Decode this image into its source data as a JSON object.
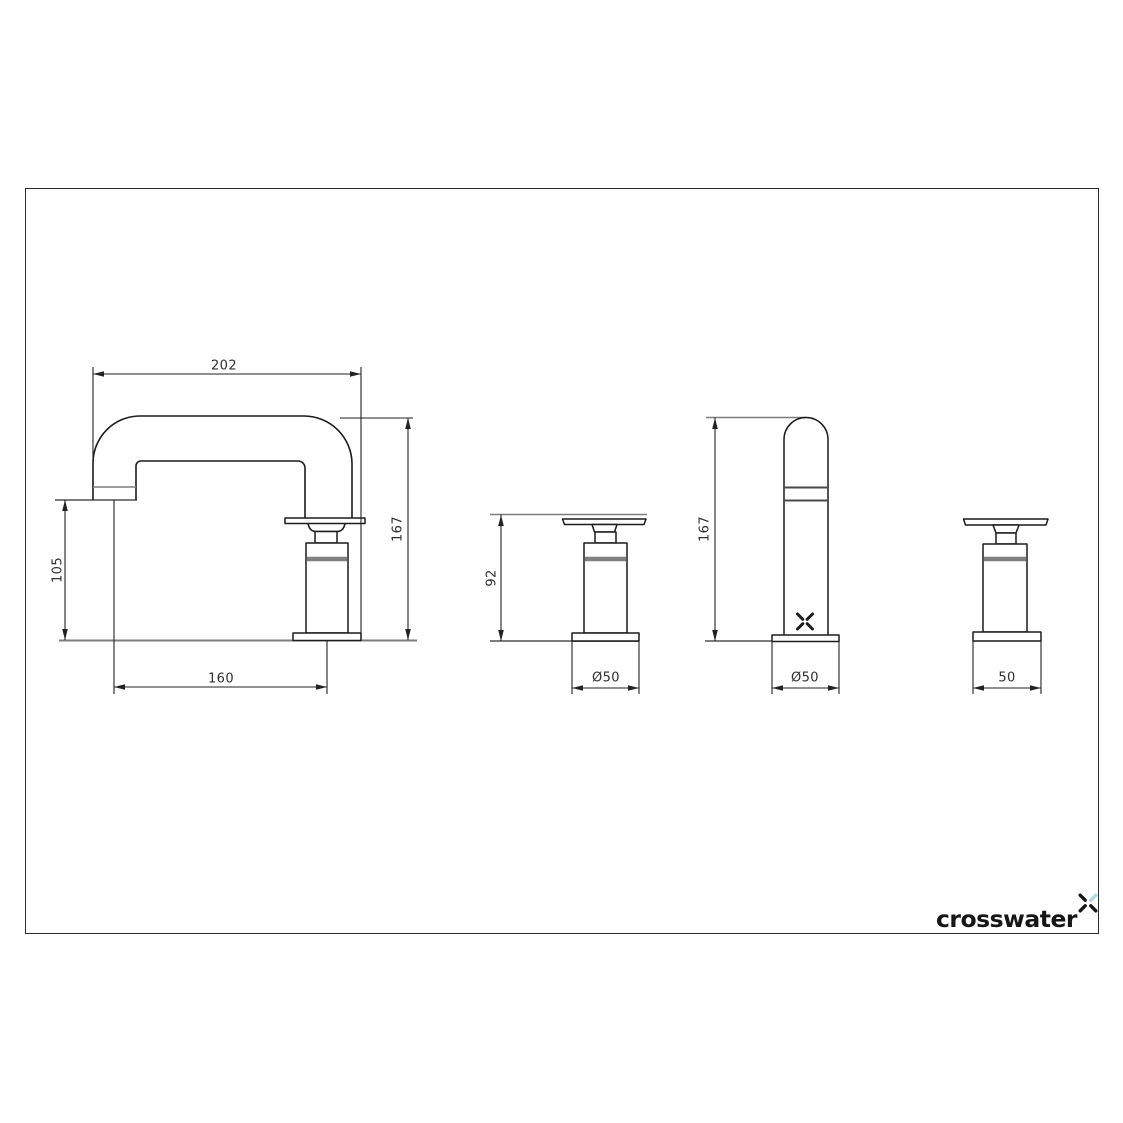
{
  "title": "Crosswater tap technical drawing",
  "colors": {
    "line": "#1c1c1c",
    "dim": "#222222",
    "soft": "#7d7d7d",
    "band": "#808080",
    "text": "#2f2f2f",
    "logo_text": "#161616",
    "logo_accent": "#aed9e0",
    "background": "#ffffff",
    "border": "#2b2b2b"
  },
  "views": {
    "spout_side": {
      "name": "spout-side-view",
      "dims": {
        "reach": "202",
        "spout_height": "105",
        "centres": "160",
        "overall_height": "167"
      }
    },
    "handle_side": {
      "name": "handle-side-view",
      "dims": {
        "height": "92",
        "base_diameter": "Ø50"
      }
    },
    "spout_front": {
      "name": "spout-front-view",
      "dims": {
        "overall_height": "167",
        "base_diameter": "Ø50"
      }
    },
    "handle_front": {
      "name": "handle-front-view",
      "dims": {
        "base_width": "50"
      }
    }
  },
  "logo": {
    "text": "crosswater"
  }
}
